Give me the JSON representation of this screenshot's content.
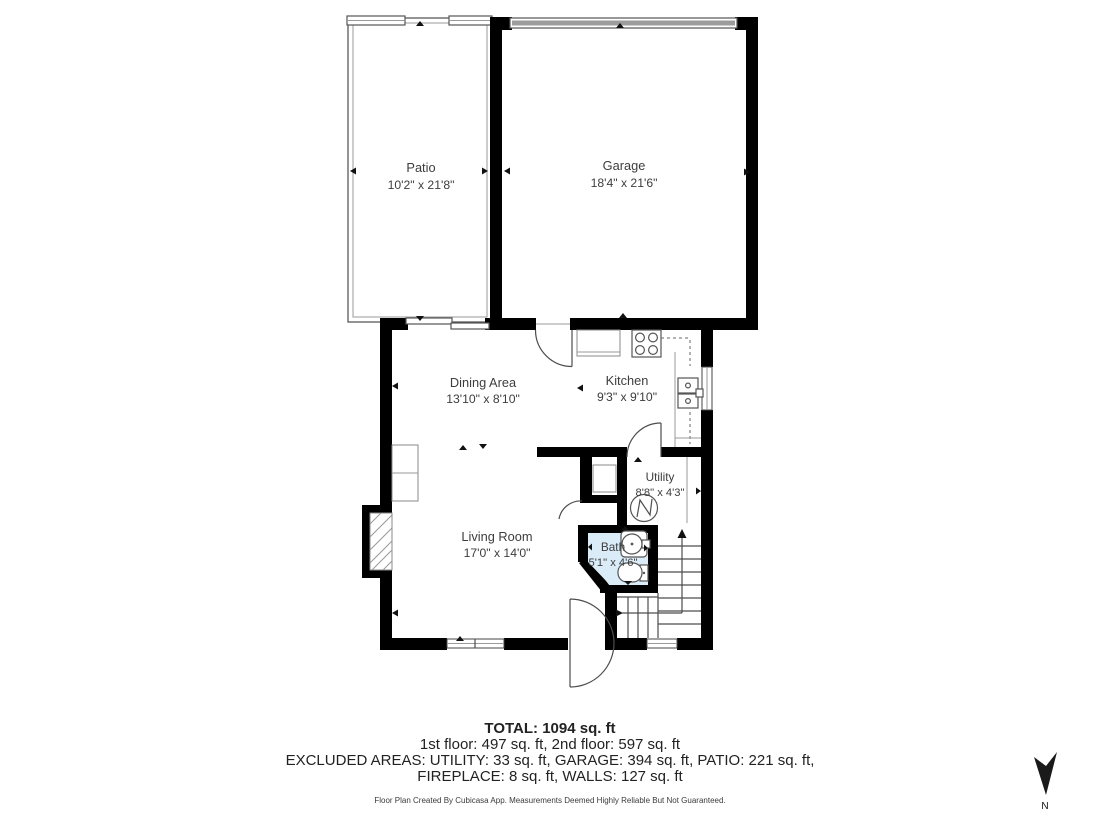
{
  "rooms": {
    "patio": {
      "name": "Patio",
      "dims": "10'2\" x 21'8\""
    },
    "garage": {
      "name": "Garage",
      "dims": "18'4\" x 21'6\""
    },
    "dining": {
      "name": "Dining Area",
      "dims": "13'10\" x 8'10\""
    },
    "kitchen": {
      "name": "Kitchen",
      "dims": "9'3\" x 9'10\""
    },
    "utility": {
      "name": "Utility",
      "dims": "8'8\" x 4'3\""
    },
    "bath": {
      "name": "Bath",
      "dims": "5'1\" x 4'6\""
    },
    "living": {
      "name": "Living Room",
      "dims": "17'0\" x 14'0\""
    }
  },
  "summary": {
    "total": "TOTAL: 1094 sq. ft",
    "floors": "1st floor: 497 sq. ft, 2nd floor: 597 sq. ft",
    "excluded1": "EXCLUDED AREAS: UTILITY: 33 sq. ft, GARAGE: 394 sq. ft, PATIO: 221 sq. ft,",
    "excluded2": "FIREPLACE: 8 sq. ft, WALLS: 127 sq. ft",
    "disclaimer": "Floor Plan Created By Cubicasa App. Measurements Deemed Highly Reliable But Not Guaranteed."
  },
  "compass": {
    "north_label": "N"
  },
  "colors": {
    "wall": "#000000",
    "bath_fill": "#d9ecf8",
    "garage_door_fill": "#9c9c9c",
    "line": "#555555",
    "text": "#3d3d3d"
  }
}
